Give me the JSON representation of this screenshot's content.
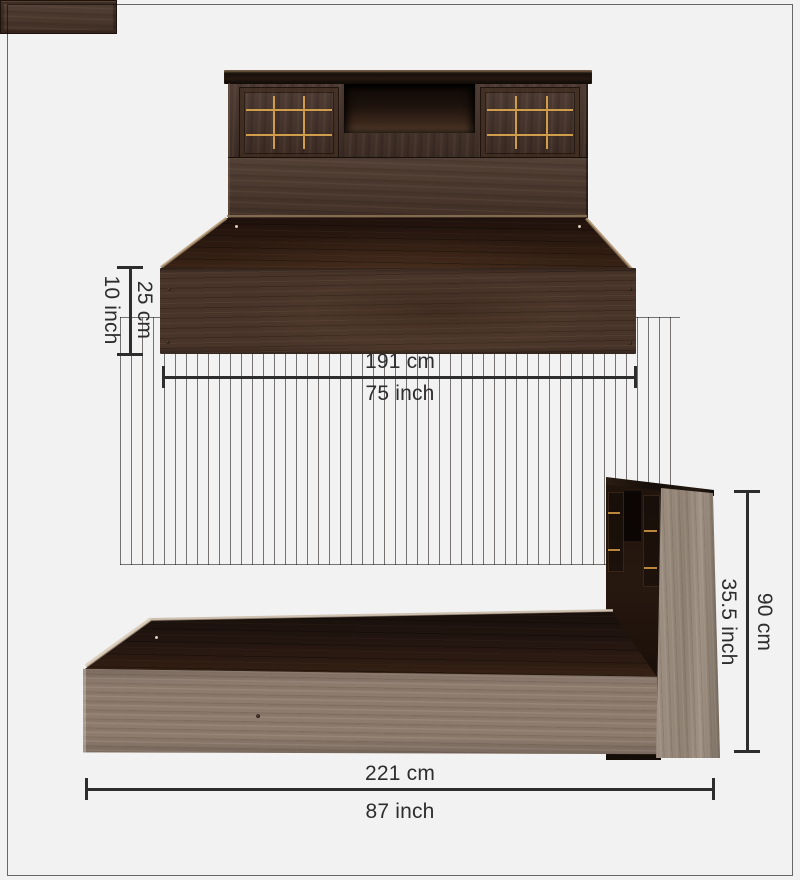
{
  "figure": {
    "type": "product-dimension-diagram",
    "subject": "storage bed with headboard cabinets, front view (top) and side view (bottom)"
  },
  "colors": {
    "background": "#f2f2f3",
    "dimension_ink": "#2d2d2d",
    "walnut_dark": "#46332a",
    "gray_oak": "#8d7b6e",
    "gold_inlay": "#cf9d4c"
  },
  "views": {
    "front": {
      "height_cm": "25 cm",
      "height_inch": "10 inch",
      "width_cm": "191 cm",
      "width_inch": "75 inch"
    },
    "side": {
      "height_cm": "90 cm",
      "height_inch": "35.5 inch",
      "length_cm": "221 cm",
      "length_inch": "87 inch"
    }
  }
}
